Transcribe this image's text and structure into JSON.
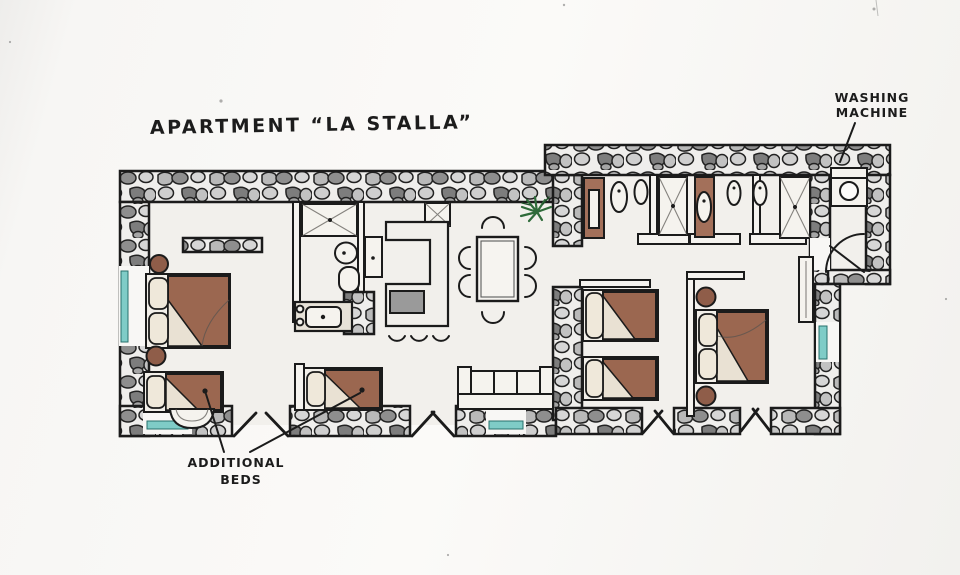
{
  "page": {
    "title": "APARTMENT “LA STALLA”"
  },
  "annotations": {
    "washing_machine": {
      "line1": "WASHING",
      "line2": "MACHINE"
    },
    "additional_beds": {
      "line1": "ADDITIONAL",
      "line2": "BEDS"
    }
  },
  "plan": {
    "type": "hand-drawn apartment floor plan",
    "wings": [
      "left-wing",
      "right-wing",
      "laundry-room"
    ],
    "furniture_icons": [
      "double-bed",
      "additional-single-bed",
      "twin-beds",
      "dining-table-six-chairs",
      "sofa",
      "kitchen-counter",
      "stove",
      "bar-stools",
      "shower",
      "toilet",
      "bidet",
      "vanity-sink",
      "washing-machine",
      "wardrobe",
      "nightstand",
      "potted-plant",
      "window",
      "door-swing",
      "wall-shelf"
    ],
    "colors": {
      "ink": "#1c1c1c",
      "paper": "#f8f7f5",
      "floor": "#f2f0ec",
      "stone_light": "#d6d6d6",
      "stone_mid": "#a8a8a8",
      "stone_dark": "#7d7d7d",
      "bed_brown": "#9b6750",
      "pillow_cream": "#efe8da",
      "window_teal": "#7fccc7",
      "plant_green": "#2f6b3a",
      "appliance_gray": "#9a9a9a"
    }
  }
}
